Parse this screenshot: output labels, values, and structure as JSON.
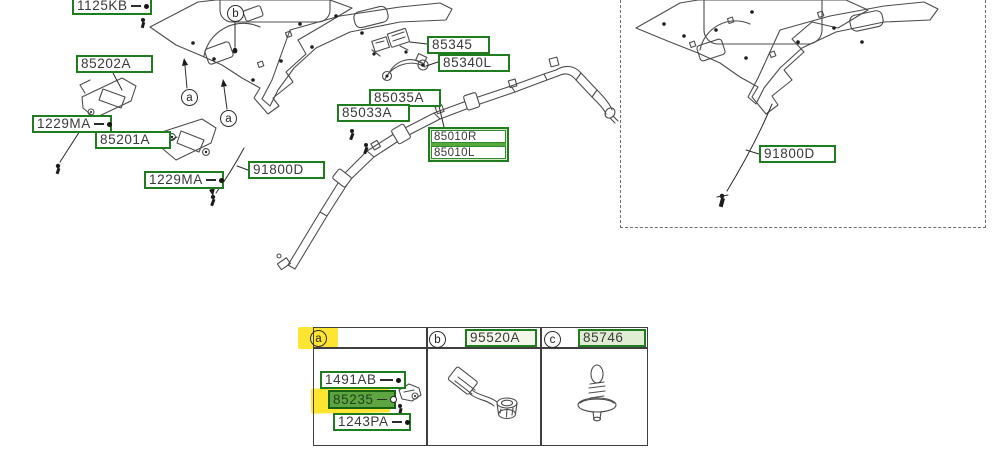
{
  "colors": {
    "label_border_green": "#1f7d1f",
    "mid_green_fill": "#5da540",
    "light_green_fill": "#dbe8c9",
    "highlight_yellow": "#ffe431",
    "lineart_gray": "#4d4d4d"
  },
  "diagram_labels": {
    "p1125kb": "1125KB",
    "p85202a": "85202A",
    "p1229ma_a": "1229MA",
    "p85201a": "85201A",
    "p1229ma_b": "1229MA",
    "p91800d_left": "91800D",
    "p85345": "85345",
    "p85340l": "85340L",
    "p85035a": "85035A",
    "p85033a": "85033A",
    "p85010r": "85010R",
    "p85010l": "85010L",
    "p91800d_right": "91800D"
  },
  "callouts": {
    "a": "a",
    "b": "b",
    "c": "c"
  },
  "table": {
    "header": {
      "a": "a",
      "b": "b",
      "c": "c",
      "part_b": "95520A",
      "part_c": "85746"
    },
    "cell_a_parts": {
      "p1491ab": "1491AB",
      "p85235": "85235",
      "p1243pa": "1243PA"
    }
  }
}
